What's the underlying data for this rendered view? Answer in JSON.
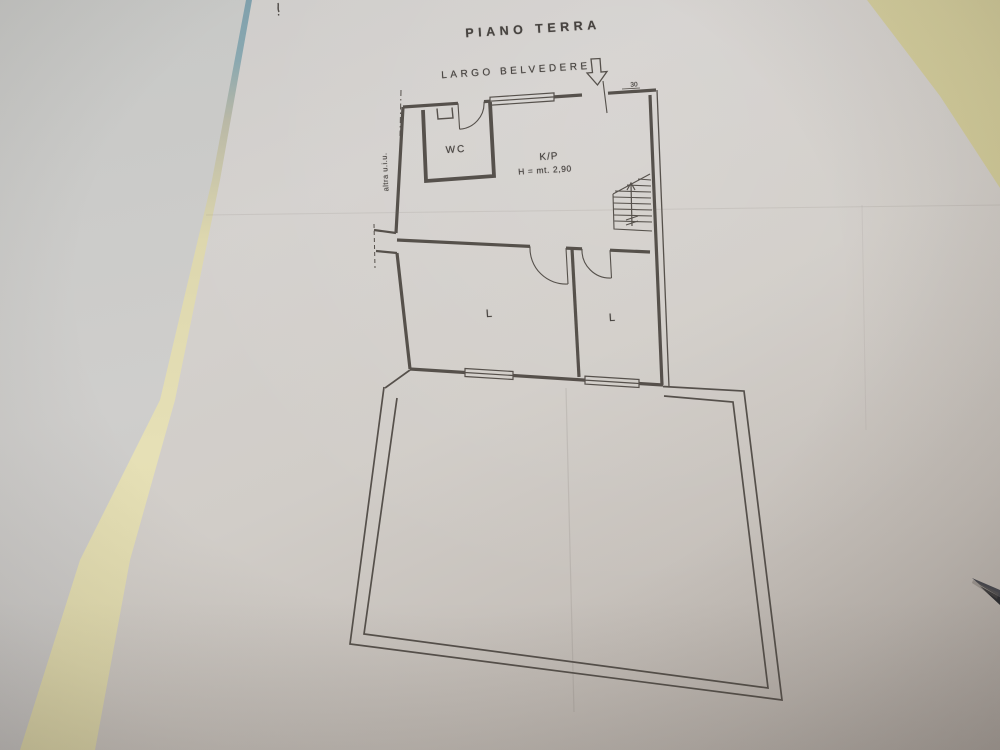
{
  "floorplan": {
    "title": "PIANO TERRA",
    "street": "LARGO BELVEDERE",
    "labels": {
      "wc": "WC",
      "kp": "K/P",
      "kp_height": "H = mt. 2,90",
      "room_left": "L",
      "room_right": "L",
      "other_unit": "altra u.i.u.",
      "entry_dimension": "30"
    },
    "icons": {
      "entrance": "entrance-arrow-down",
      "stairs": "stairs-up-arrow"
    },
    "colors": {
      "ink": "#4b4641",
      "paper": "#d0cdc9",
      "left_sheet": "#cbcac8",
      "desk": "#d8d2a4",
      "folder_edge_teal": "#85a3ad",
      "gap_strip_cream": "#e2dcb2"
    }
  }
}
